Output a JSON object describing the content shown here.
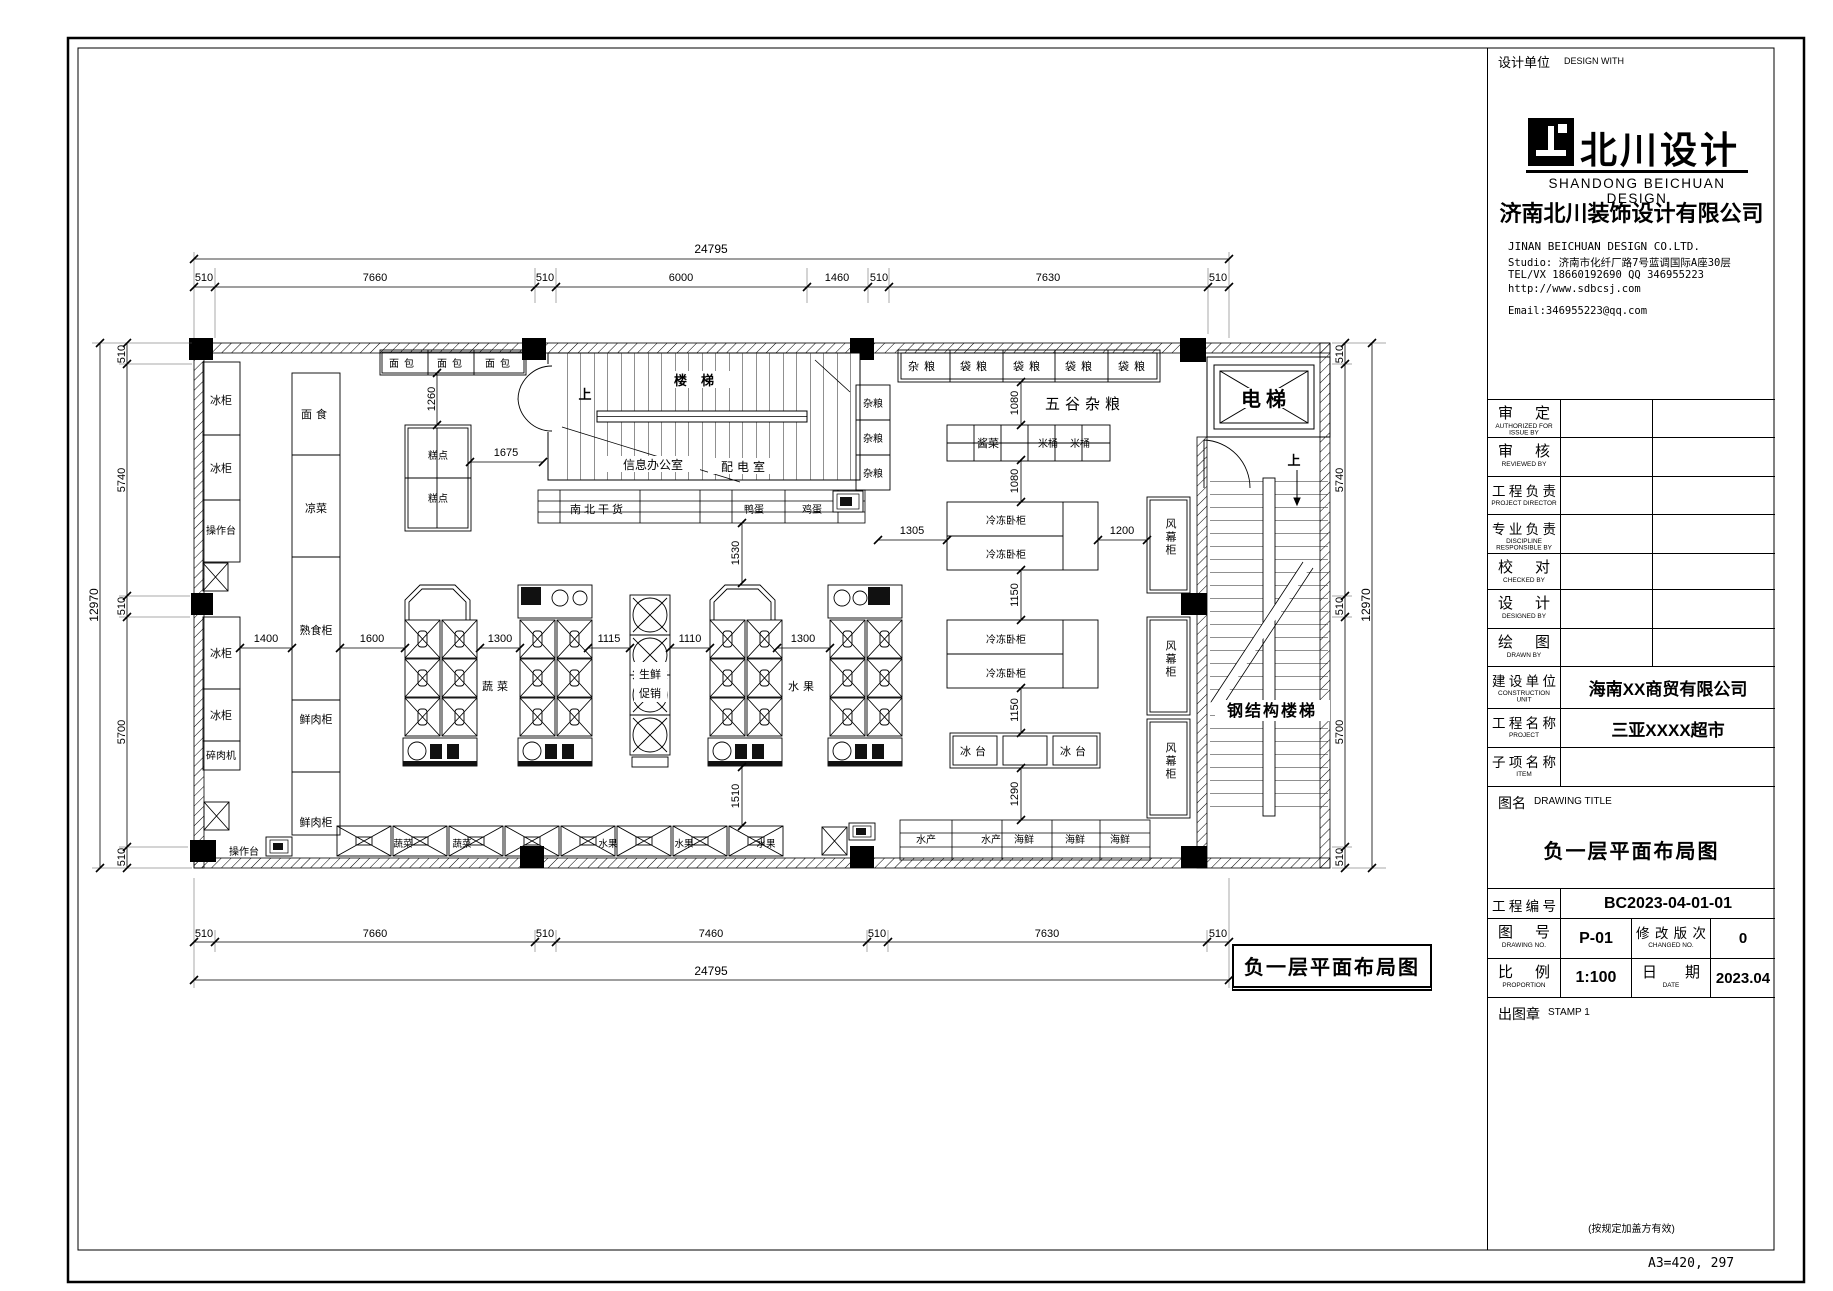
{
  "plan": {
    "title": "负一层平面布局图",
    "rooms": {
      "stairs": "楼梯",
      "up": "上",
      "info_office": "信息办公室",
      "power_room": "配电室",
      "elevator": "电梯",
      "steel_stairs": "钢结构楼梯"
    },
    "fixtures": {
      "freezer": "冰柜",
      "worktable": "操作台",
      "meat_grinder": "碎肉机",
      "noodle": "面食",
      "cold_dish": "凉菜",
      "deli_cabinet": "熟食柜",
      "fresh_meat": "鲜肉柜",
      "bread": "面包",
      "pastry": "糕点",
      "dry_goods": "南北干货",
      "duck_egg": "鸭蛋",
      "egg": "鸡蛋",
      "grains": "杂粮",
      "bag_grain": "袋粮",
      "five_grains": "五谷杂粮",
      "pickles": "酱菜",
      "rice_bucket": "米桶",
      "chest_freezer": "冷冻卧柜",
      "air_curtain": "风幕柜",
      "ice_table": "冰台",
      "vegetable": "蔬菜",
      "fruit": "水果",
      "fresh": "生鲜",
      "promo": "促销",
      "aquatic": "水产",
      "seafood": "海鲜"
    }
  },
  "dims": {
    "total_width": "24795",
    "total_height": "12970",
    "top": [
      "510",
      "7660",
      "510",
      "6000",
      "1460",
      "510",
      "7630",
      "510"
    ],
    "bottom": [
      "510",
      "7660",
      "510",
      "7460",
      "510",
      "7630",
      "510"
    ],
    "left": [
      "510",
      "5740",
      "510",
      "5700",
      "510"
    ],
    "right": [
      "510",
      "5740",
      "510",
      "5700",
      "510"
    ],
    "interior": {
      "d1260": "1260",
      "d1675": "1675",
      "d1530": "1530",
      "d1510": "1510",
      "d1400": "1400",
      "d1600": "1600",
      "d1300": "1300",
      "d1115": "1115",
      "d1110": "1110",
      "d1305": "1305",
      "d1200": "1200",
      "d1080": "1080",
      "d1150": "1150",
      "d1290": "1290"
    }
  },
  "title_block": {
    "header_label": "设计单位",
    "header_label_en": "DESIGN WITH",
    "brand": "北川设计",
    "brand_en": "SHANDONG BEICHUAN DESIGN",
    "company": "济南北川装饰设计有限公司",
    "company_en": "JINAN  BEICHUAN  DESIGN CO.LTD.",
    "studio": "Studio: 济南市化纤厂路7号蓝调国际A座30层",
    "contact": "TEL/VX 18660192690    QQ 346955223",
    "website": "http://www.sdbcsj.com",
    "email": "Email:346955223@qq.com",
    "sign_rows": [
      {
        "zh": "审定",
        "en": "AUTHORIZED FOR ISSUE BY"
      },
      {
        "zh": "审核",
        "en": "REVIEWED BY"
      },
      {
        "zh": "工程负责",
        "en": "PROJECT DIRECTOR"
      },
      {
        "zh": "专业负责",
        "en": "DISCIPLINE RESPONSIBLE BY"
      },
      {
        "zh": "校对",
        "en": "CHECKED BY"
      },
      {
        "zh": "设计",
        "en": "DESIGNED BY"
      },
      {
        "zh": "绘图",
        "en": "DRAWN BY"
      }
    ],
    "construction": {
      "zh": "建设单位",
      "en": "CONSTRUCTION UNIT",
      "value": "海南XX商贸有限公司"
    },
    "project": {
      "zh": "工程名称",
      "en": "PROJECT",
      "value": "三亚XXXX超市"
    },
    "item": {
      "zh": "子项名称",
      "en": "ITEM",
      "value": ""
    },
    "drawing_title": {
      "zh": "图名",
      "en": "DRAWING TITLE",
      "value": "负一层平面布局图"
    },
    "project_no": {
      "zh": "工程编号",
      "value": "BC2023-04-01-01"
    },
    "drawing_no": {
      "zh": "图号",
      "en": "DRAWING NO.",
      "value": "P-01"
    },
    "revision": {
      "zh": "修改版次",
      "en": "CHANGED NO.",
      "value": "0"
    },
    "scale": {
      "zh": "比例",
      "en": "PROPORTION",
      "value": "1:100"
    },
    "date": {
      "zh": "日期",
      "en": "DATE",
      "value": "2023.04"
    },
    "stamp": {
      "zh": "出图章",
      "en": "STAMP 1",
      "note": "(按规定加盖方有效)"
    },
    "paper_note": "A3=420, 297"
  }
}
